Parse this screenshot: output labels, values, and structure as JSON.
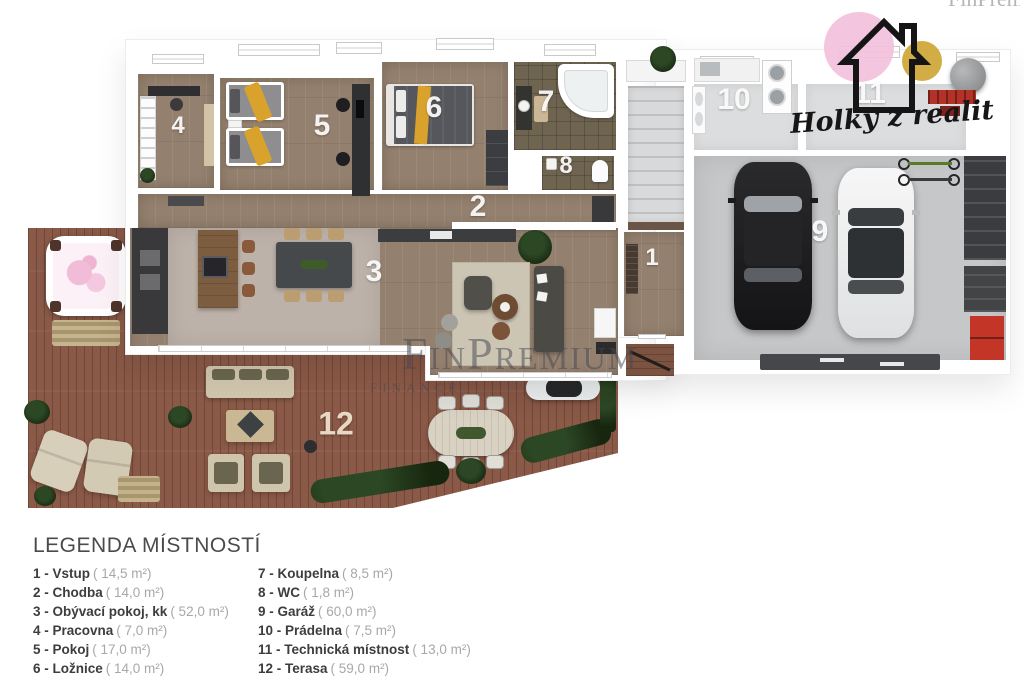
{
  "page": {
    "background": "#ffffff"
  },
  "watermark": {
    "name": "FinPremium",
    "subtitle": "FINANCE",
    "corner_fragment": "FinPremium",
    "color": "#46465270"
  },
  "logo": {
    "brand": "Holky z realit",
    "pink_color": "#f2c0dc",
    "gold_color": "#d0a93b",
    "outline_color": "#151515",
    "icon": "house-outline-icon"
  },
  "floor_plan": {
    "labels": {
      "r1": "1",
      "r2": "2",
      "r3": "3",
      "r4": "4",
      "r5": "5",
      "r6": "6",
      "r7": "7",
      "r8": "8",
      "r9": "9",
      "r10": "10",
      "r11": "11",
      "r12": "12"
    },
    "colors": {
      "interior_wood": "#94806e",
      "terrace_deck": "#8a5947",
      "bathroom_tile": "#6e6450",
      "garage_floor": "#c5c7c9",
      "utility_floor": "#dcddde",
      "kitchen_concrete": "#bdb2a9",
      "accent_yellow": "#d9a22c",
      "walls": "#ffffff"
    }
  },
  "legend": {
    "title": "LEGENDA MÍSTNOSTÍ",
    "col1": [
      {
        "label": "1 - Vstup",
        "area": "( 14,5 m²)"
      },
      {
        "label": "2 - Chodba",
        "area": "( 14,0 m²)"
      },
      {
        "label": "3 - Obývací pokoj, kk",
        "area": "( 52,0 m²)"
      },
      {
        "label": "4 - Pracovna",
        "area": "( 7,0 m²)"
      },
      {
        "label": "5 - Pokoj",
        "area": "( 17,0 m²)"
      },
      {
        "label": "6 - Ložnice",
        "area": "( 14,0 m²)"
      }
    ],
    "col2": [
      {
        "label": "7 - Koupelna",
        "area": "( 8,5 m²)"
      },
      {
        "label": "8 - WC",
        "area": "( 1,8 m²)"
      },
      {
        "label": "9 - Garáž",
        "area": "( 60,0 m²)"
      },
      {
        "label": "10 - Prádelna",
        "area": "( 7,5 m²)"
      },
      {
        "label": "11 - Technická místnost",
        "area": "( 13,0 m²)"
      },
      {
        "label": "12 - Terasa",
        "area": "( 59,0 m²)"
      }
    ]
  }
}
